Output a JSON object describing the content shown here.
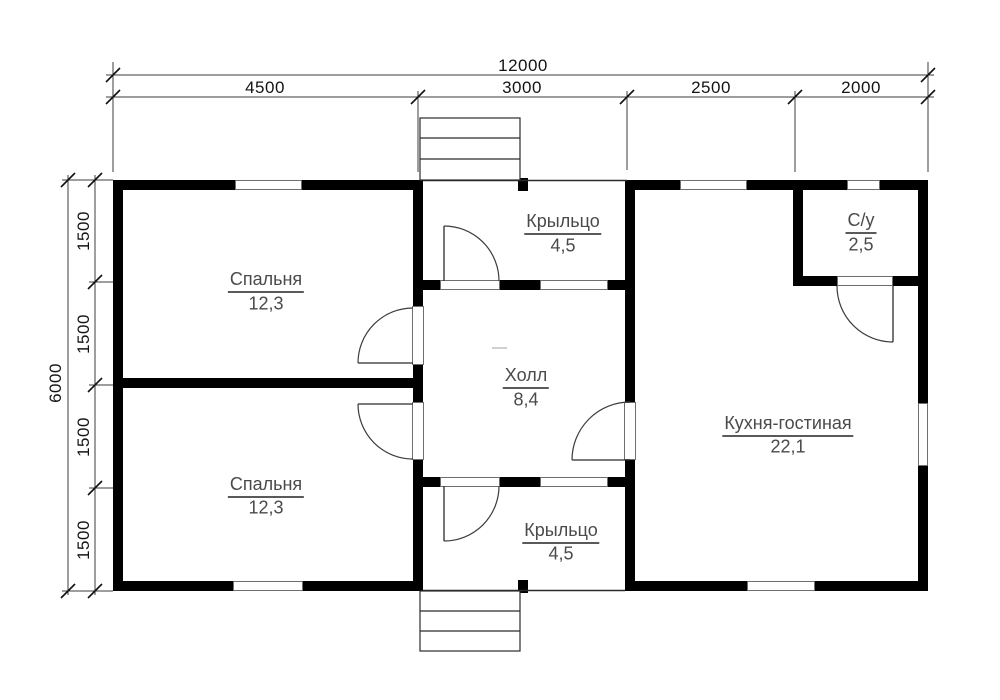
{
  "canvas": {
    "width": 1000,
    "height": 700,
    "background": "#ffffff"
  },
  "colors": {
    "wall": "#000000",
    "thin_line": "#2b2b2b",
    "arc_line": "#3c3c3c",
    "dim_line": "#3c3c3c",
    "tick": "#111111",
    "opening_border": "#6e6e6e",
    "room_text": "#4a4a4a",
    "dim_text": "#141414",
    "faint_mark": "#c0c0c0"
  },
  "rooms": [
    {
      "id": "bedroom-1",
      "name": "Спальня",
      "area": "12,3",
      "x": 266,
      "name_y": 281,
      "area_y": 304
    },
    {
      "id": "bedroom-2",
      "name": "Спальня",
      "area": "12,3",
      "x": 266,
      "name_y": 486,
      "area_y": 508
    },
    {
      "id": "hall",
      "name": "Холл",
      "area": "8,4",
      "x": 526,
      "name_y": 377,
      "area_y": 400
    },
    {
      "id": "porch-top",
      "name": "Крыльцо",
      "area": "4,5",
      "x": 563,
      "name_y": 223,
      "area_y": 246
    },
    {
      "id": "porch-bottom",
      "name": "Крыльцо",
      "area": "4,5",
      "x": 561,
      "name_y": 532,
      "area_y": 554
    },
    {
      "id": "kitchen-living",
      "name": "Кухня-гостиная",
      "area": "22,1",
      "x": 788,
      "name_y": 425,
      "area_y": 447
    },
    {
      "id": "bathroom",
      "name": "С/у",
      "area": "2,5",
      "x": 861,
      "name_y": 222,
      "area_y": 245
    }
  ],
  "dim_labels": [
    {
      "label": "12000",
      "x": 523,
      "y": 66,
      "rot": 0
    },
    {
      "label": "4500",
      "x": 265,
      "y": 88,
      "rot": 0
    },
    {
      "label": "3000",
      "x": 522,
      "y": 88,
      "rot": 0
    },
    {
      "label": "2500",
      "x": 711,
      "y": 88,
      "rot": 0
    },
    {
      "label": "2000",
      "x": 861,
      "y": 88,
      "rot": 0
    },
    {
      "label": "6000",
      "x": 56,
      "y": 383,
      "rot": -90
    },
    {
      "label": "1500",
      "x": 84,
      "y": 231,
      "rot": -90
    },
    {
      "label": "1500",
      "x": 84,
      "y": 334,
      "rot": -90
    },
    {
      "label": "1500",
      "x": 84,
      "y": 437,
      "rot": -90
    },
    {
      "label": "1500",
      "x": 84,
      "y": 540,
      "rot": -90
    }
  ],
  "walls": [
    [
      113,
      180,
      310,
      10
    ],
    [
      627,
      180,
      301,
      10
    ],
    [
      113,
      581,
      310,
      10
    ],
    [
      625,
      581,
      303,
      10
    ],
    [
      113,
      180,
      10,
      411
    ],
    [
      918,
      180,
      10,
      411
    ],
    [
      113,
      378,
      310,
      10
    ],
    [
      413,
      180,
      10,
      411
    ],
    [
      625,
      180,
      10,
      411
    ],
    [
      413,
      280,
      222,
      10
    ],
    [
      413,
      477,
      222,
      10
    ],
    [
      793,
      190,
      10,
      96
    ],
    [
      793,
      276,
      135,
      10
    ],
    [
      518,
      178,
      10,
      13
    ],
    [
      518,
      580,
      10,
      13
    ]
  ],
  "windows": [
    [
      235,
      180,
      67,
      10
    ],
    [
      680,
      180,
      67,
      10
    ],
    [
      847,
      180,
      33,
      10
    ],
    [
      233,
      581,
      70,
      10
    ],
    [
      747,
      581,
      68,
      10
    ],
    [
      918,
      403,
      10,
      63
    ],
    [
      540,
      280,
      68,
      10
    ],
    [
      540,
      477,
      68,
      10
    ]
  ],
  "door_openings": [
    [
      412,
      306,
      12,
      59
    ],
    [
      412,
      402,
      12,
      58
    ],
    [
      440,
      280,
      60,
      10
    ],
    [
      440,
      477,
      60,
      10
    ],
    [
      624,
      402,
      12,
      58
    ],
    [
      837,
      276,
      56,
      10
    ]
  ],
  "door_swings": [
    {
      "leaf": [
        413,
        363,
        358,
        363
      ],
      "arc": "M 358,363 A 55,55 0 0 1 413,308"
    },
    {
      "leaf": [
        413,
        404,
        358,
        404
      ],
      "arc": "M 358,404 A 55,55 0 0 0 413,459"
    },
    {
      "leaf": [
        444,
        281,
        444,
        226
      ],
      "arc": "M 444,226 A 55,55 0 0 1 499,281"
    },
    {
      "leaf": [
        444,
        486,
        444,
        541
      ],
      "arc": "M 444,541 A 55,55 0 0 0 499,486"
    },
    {
      "leaf": [
        630,
        460,
        572,
        460
      ],
      "arc": "M 572,460 A 58,58 0 0 1 630,402"
    },
    {
      "leaf": [
        893,
        286,
        893,
        342
      ],
      "arc": "M 837,286 A 56,56 0 0 0 893,342"
    }
  ],
  "stairs": [
    {
      "id": "stairs-top",
      "rect": [
        420,
        118,
        100,
        62
      ],
      "treads": [
        138,
        159
      ]
    },
    {
      "id": "stairs-bottom",
      "rect": [
        420,
        591,
        100,
        60
      ],
      "treads": [
        611,
        631
      ]
    }
  ],
  "porch_edges": [
    [
      423,
      180.5,
      627,
      180.5
    ],
    [
      423,
      590.5,
      625,
      590.5
    ]
  ],
  "dim_lines": [
    [
      106,
      75,
      934,
      75
    ],
    [
      106,
      97,
      934,
      97
    ],
    [
      68,
      175,
      68,
      595
    ],
    [
      95,
      175,
      95,
      595
    ]
  ],
  "dim_extensions": [
    [
      113,
      62,
      113,
      172
    ],
    [
      928,
      62,
      928,
      172
    ],
    [
      418,
      91,
      418,
      172
    ],
    [
      627,
      91,
      627,
      170
    ],
    [
      795,
      91,
      795,
      172
    ],
    [
      62,
      180,
      113,
      180
    ],
    [
      89,
      282,
      113,
      282
    ],
    [
      89,
      385,
      113,
      385
    ],
    [
      89,
      488,
      113,
      488
    ],
    [
      62,
      591,
      113,
      591
    ]
  ],
  "dim_ticks": [
    [
      113,
      75
    ],
    [
      928,
      75
    ],
    [
      113,
      97
    ],
    [
      418,
      97
    ],
    [
      627,
      97
    ],
    [
      795,
      97
    ],
    [
      928,
      97
    ],
    [
      68,
      180
    ],
    [
      68,
      591
    ],
    [
      95,
      180
    ],
    [
      95,
      282
    ],
    [
      95,
      385
    ],
    [
      95,
      488
    ],
    [
      95,
      591
    ]
  ],
  "misc_marks": [
    [
      492,
      348,
      507,
      348
    ]
  ]
}
